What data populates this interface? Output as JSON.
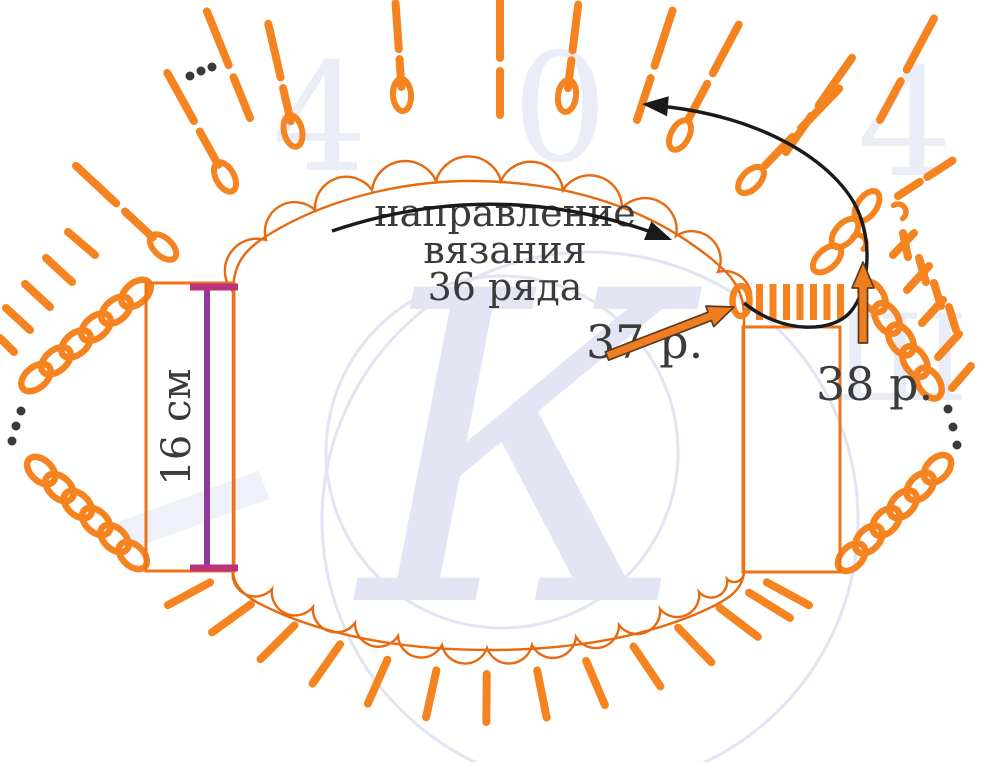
{
  "labels": {
    "direction_line1": "направление",
    "direction_line2": "вязания",
    "direction_line3": "36 ряда",
    "row37": "37 р.",
    "row38": "38 р.",
    "size": "16 см"
  },
  "colors": {
    "stitch_orange": "#f5831f",
    "outline_orange": "#e8690e",
    "rect_orange": "#ef7318",
    "arrow_fill": "#f07d1f",
    "arrow_stroke": "#5a3c22",
    "black": "#1a1a1a",
    "text": "#3b3b3b",
    "purple_line": "#8e3a9b",
    "purple_cap": "#b9347c",
    "dot": "#3a3a3a",
    "watermark": "#e2e4f3",
    "watermark_faint": "#eef0fa"
  },
  "chart_data": {
    "type": "diagram",
    "subject": "crochet-pattern-rows-36-38",
    "body_path": "M 233,570 L 233,292 C 233,258 250,245 280,228 C 330,200 400,181 470,181 C 560,181 640,205 700,250 C 730,272 744,288 744,316 L 744,570 C 744,592 724,602 694,615 C 630,641 560,650 489,650 C 418,650 348,641 284,615 C 254,602 233,592 233,570 Z",
    "top_scallop_points": [
      [
        233,
        292
      ],
      [
        266,
        240
      ],
      [
        315,
        210
      ],
      [
        372,
        190
      ],
      [
        436,
        181
      ],
      [
        501,
        181
      ],
      [
        563,
        190
      ],
      [
        622,
        208
      ],
      [
        676,
        236
      ],
      [
        718,
        272
      ],
      [
        744,
        316
      ]
    ],
    "bottom_scallop_points": [
      [
        233,
        570
      ],
      [
        272,
        589
      ],
      [
        313,
        607
      ],
      [
        355,
        623
      ],
      [
        398,
        636
      ],
      [
        442,
        645
      ],
      [
        487,
        648
      ],
      [
        532,
        645
      ],
      [
        576,
        637
      ],
      [
        619,
        625
      ],
      [
        660,
        609
      ],
      [
        699,
        592
      ],
      [
        727,
        579
      ],
      [
        744,
        570
      ]
    ],
    "bottom_dash_center": [
      489,
      432
    ],
    "bottom_dash_span": [
      26,
      74
    ],
    "spokes": [
      {
        "x": 163,
        "y": 247,
        "a": 137,
        "oval": true,
        "d0": 14,
        "li": 38,
        "g": 12,
        "lo": 55
      },
      {
        "x": 225,
        "y": 177,
        "a": 119,
        "oval": true,
        "d0": 14,
        "li": 38,
        "g": 12,
        "lo": 55
      },
      {
        "x": 293,
        "y": 131,
        "a": 103,
        "oval": true,
        "d0": 10,
        "li": 34,
        "g": 11,
        "lo": 55
      },
      {
        "x": 402,
        "y": 95,
        "a": 94,
        "oval": true,
        "d0": 8,
        "li": 28,
        "g": 10,
        "lo": 46
      },
      {
        "x": 567,
        "y": 96,
        "a": 83,
        "oval": true,
        "d0": 8,
        "li": 28,
        "g": 10,
        "lo": 46
      },
      {
        "x": 680,
        "y": 135,
        "a": 62,
        "oval": true,
        "d0": 18,
        "li": 40,
        "g": 12,
        "lo": 55
      },
      {
        "x": 751,
        "y": 180,
        "a": 46,
        "oval": true,
        "d0": 20,
        "li": 40,
        "g": 12,
        "lo": 55
      },
      {
        "x": 250,
        "y": 118,
        "a": 112
      },
      {
        "x": 500,
        "y": 115,
        "a": 90
      },
      {
        "x": 637,
        "y": 120,
        "a": 72
      },
      {
        "x": 786,
        "y": 152,
        "a": 55
      },
      {
        "x": 880,
        "y": 120,
        "a": 62
      },
      {
        "x": 898,
        "y": 196,
        "a": 33,
        "li": 26,
        "g": 9,
        "lo": 30
      }
    ],
    "dash_segments": [
      [
        95,
        255,
        68,
        232
      ],
      [
        72,
        282,
        46,
        258
      ],
      [
        50,
        307,
        25,
        284
      ],
      [
        30,
        330,
        6,
        308
      ],
      [
        14,
        352,
        0,
        338
      ],
      [
        903,
        233,
        908,
        257
      ],
      [
        919,
        258,
        926,
        282
      ],
      [
        934,
        283,
        941,
        306
      ],
      [
        949,
        307,
        956,
        330
      ],
      [
        914,
        233,
        893,
        255
      ],
      [
        929,
        266,
        907,
        290
      ],
      [
        943,
        300,
        922,
        323
      ],
      [
        959,
        334,
        938,
        357
      ],
      [
        971,
        366,
        952,
        388
      ]
    ],
    "chains": [
      {
        "x1": 146,
        "y1": 285,
        "x2": 26,
        "y2": 386,
        "n": 6
      },
      {
        "x1": 32,
        "y1": 462,
        "x2": 142,
        "y2": 564,
        "n": 6
      },
      {
        "x1": 866,
        "y1": 286,
        "x2": 936,
        "y2": 394,
        "n": 5
      },
      {
        "x1": 946,
        "y1": 460,
        "x2": 843,
        "y2": 566,
        "n": 6
      }
    ],
    "corner_chain_ovals": [
      [
        827,
        259,
        -42
      ],
      [
        845,
        233,
        -48
      ],
      [
        867,
        206,
        -55
      ]
    ],
    "slip_commas": [
      [
        858,
        243,
        -40
      ],
      [
        898,
        212,
        -35
      ]
    ],
    "dots": [
      [
        190,
        76
      ],
      [
        201,
        71
      ],
      [
        212,
        67
      ],
      [
        21,
        411
      ],
      [
        16,
        426
      ],
      [
        12,
        441
      ],
      [
        948,
        409
      ],
      [
        953,
        427
      ],
      [
        957,
        445
      ]
    ],
    "row37_bars": {
      "oval": [
        741,
        301
      ],
      "x0": 756,
      "step": 13.5,
      "n": 7,
      "y1": 284,
      "y2": 320,
      "w": 7
    },
    "rects": [
      [
        146,
        283,
        88,
        288
      ],
      [
        743,
        327,
        97,
        245
      ]
    ],
    "ruler": {
      "x": 207,
      "y1": 287,
      "y2": 568,
      "cap_x1": 190,
      "cap_x2": 238
    },
    "black_arrows": [
      {
        "path": "M 332,231 Q 500,174 668,238",
        "tip": [
          672,
          240
        ],
        "ang": 21
      },
      {
        "path": "M 744,303 C 782,334 834,334 852,310 C 868,289 872,248 860,216 C 844,170 770,114 648,105",
        "tip": [
          642,
          104
        ],
        "ang": 185
      }
    ],
    "orange_arrows": [
      {
        "x1": 607,
        "y1": 356,
        "x2": 734,
        "y2": 307
      },
      {
        "x1": 863,
        "y1": 343,
        "x2": 863,
        "y2": 262
      }
    ],
    "watermark": {
      "circles": [
        [
          502,
          452,
          176
        ],
        [
          590,
          520,
          268
        ]
      ],
      "letters": [
        {
          "t": "4",
          "x": 320,
          "y": 170,
          "s": 150
        },
        {
          "t": "0",
          "x": 560,
          "y": 160,
          "s": 150
        },
        {
          "t": "4",
          "x": 905,
          "y": 175,
          "s": 150
        },
        {
          "t": "Ш",
          "x": 900,
          "y": 400,
          "s": 120
        }
      ],
      "k_letter": {
        "t": "К",
        "x": 360,
        "y": 600,
        "s": 430
      },
      "band": [
        118,
        522,
        150,
        30,
        -20
      ]
    }
  }
}
